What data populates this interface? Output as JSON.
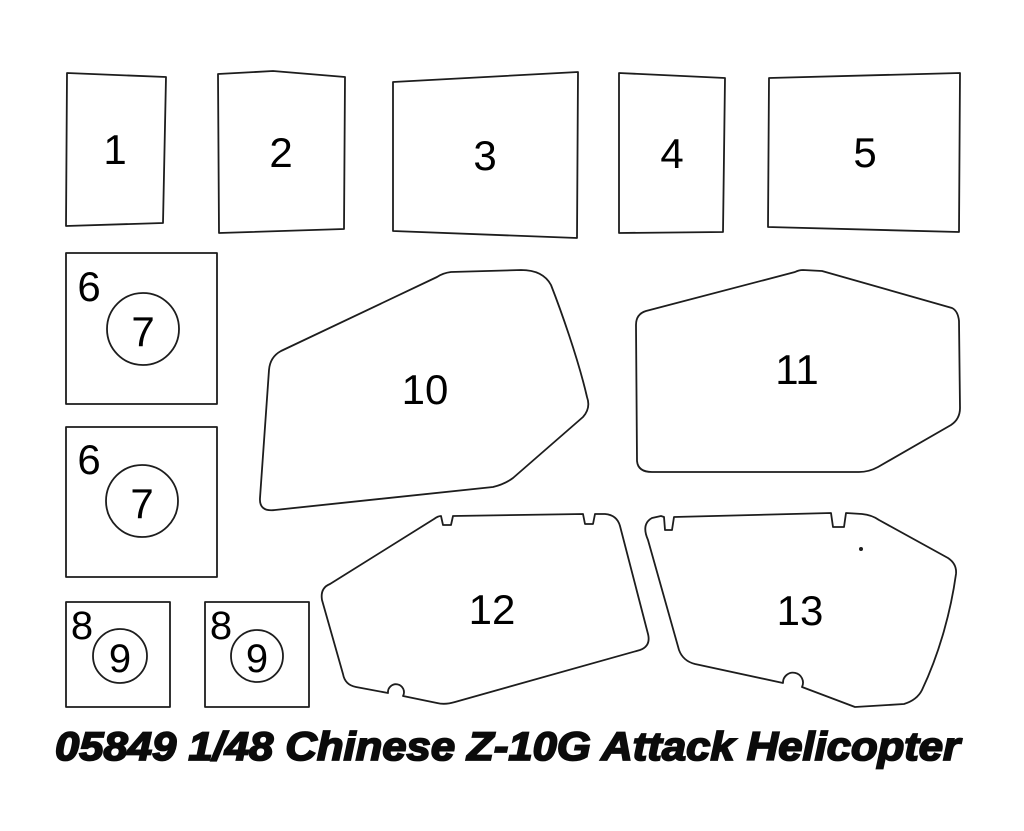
{
  "page": {
    "background_color": "#ffffff"
  },
  "diagram": {
    "title": "05849 1/48 Chinese Z-10G Attack Helicopter",
    "outline_color": "#1d1d1d",
    "label_color": "#000000",
    "parts": [
      {
        "name": "part-1",
        "label": "1"
      },
      {
        "name": "part-2",
        "label": "2"
      },
      {
        "name": "part-3",
        "label": "3"
      },
      {
        "name": "part-4",
        "label": "4"
      },
      {
        "name": "part-5",
        "label": "5"
      },
      {
        "name": "part-6-top",
        "label": "6"
      },
      {
        "name": "part-7-top",
        "label": "7"
      },
      {
        "name": "part-6-bottom",
        "label": "6"
      },
      {
        "name": "part-7-bottom",
        "label": "7"
      },
      {
        "name": "part-8-left",
        "label": "8"
      },
      {
        "name": "part-9-left",
        "label": "9"
      },
      {
        "name": "part-8-right",
        "label": "8"
      },
      {
        "name": "part-9-right",
        "label": "9"
      },
      {
        "name": "part-10",
        "label": "10"
      },
      {
        "name": "part-11",
        "label": "11"
      },
      {
        "name": "part-12",
        "label": "12"
      },
      {
        "name": "part-13",
        "label": "13"
      }
    ]
  }
}
